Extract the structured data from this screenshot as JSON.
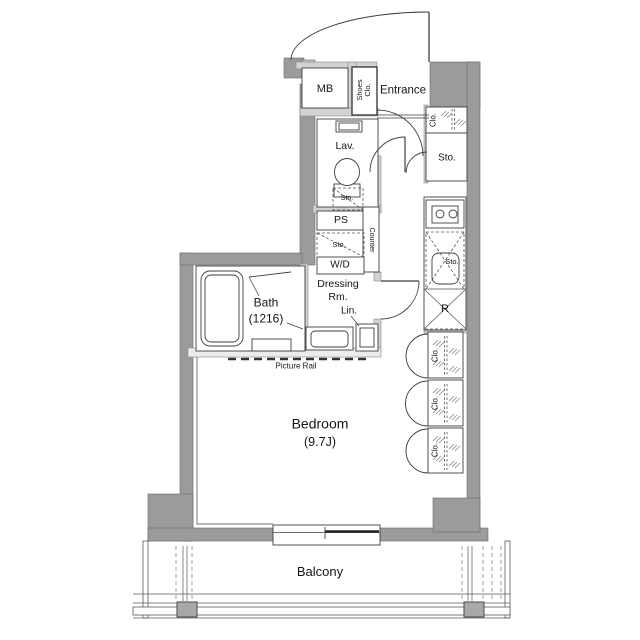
{
  "plan_type": "apartment-floor-plan",
  "colors": {
    "wall": "#9b9b9b",
    "partition": "#d2d2d2",
    "line": "#3f3f3f",
    "background": "#ffffff",
    "column": "#a8a8a8"
  },
  "labels": {
    "mb": "MB",
    "shoes_line1": "Shoes",
    "shoes_line2": "Clo.",
    "entrance": "Entrance",
    "hall_closet": "Clo.",
    "hall_storage": "Sto.",
    "lavatory": "Lav.",
    "lav_storage": "Sto.",
    "pipe_space": "PS",
    "counter": "Counter",
    "wd_storage": "Sto.",
    "washer_dryer": "W/D",
    "dressing_line1": "Dressing",
    "dressing_line2": "Rm.",
    "linen": "Lin.",
    "bath_line1": "Bath",
    "bath_line2": "(1216)",
    "kitchen_storage": "Sto.",
    "refrigerator": "R",
    "closet1": "Clo.",
    "closet2": "Clo.",
    "closet3": "Clo.",
    "bedroom_line1": "Bedroom",
    "bedroom_line2": "(9.7J)",
    "picture_rail": "Picture Rail",
    "balcony": "Balcony"
  }
}
